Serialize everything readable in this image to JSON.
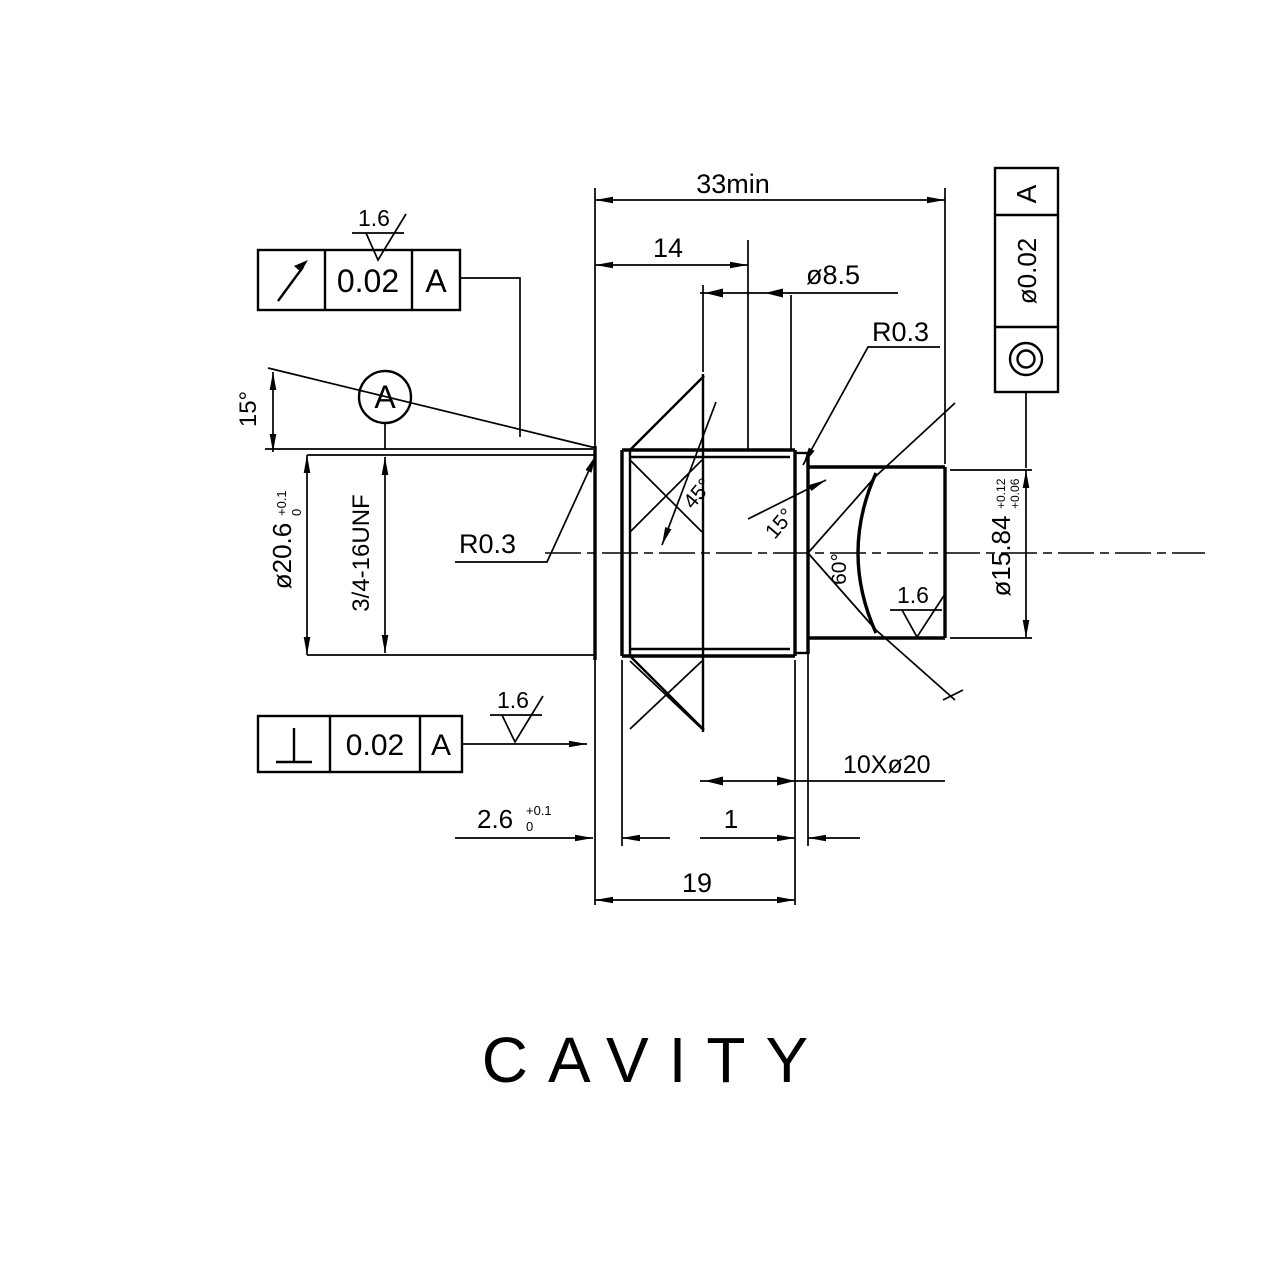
{
  "drawing": {
    "title": "CAVITY",
    "ink": "#000000",
    "background": "#ffffff"
  },
  "dims": {
    "overall_length": "33min",
    "thread_depth": "14",
    "pilot_hole": "ø8.5",
    "radius_right": "R0.3",
    "radius_left": "R0.3",
    "angle_left": "15°",
    "chamfer_angle": "45°",
    "seat_angle_small": "15°",
    "seat_angle_cone": "60°",
    "thread_minor": "ø20.6",
    "thread_minor_tol_up": "+0.1",
    "thread_minor_tol_lo": "0",
    "thread_spec": "3/4-16UNF",
    "relief_width": "2.6",
    "relief_tol_up": "+0.1",
    "relief_tol_lo": "0",
    "groove_width": "1",
    "groove_callout": "10Xø20",
    "bore_depth": "19",
    "bore_dia": "ø15.84",
    "bore_tol_up": "+0.12",
    "bore_tol_lo": "+0.06"
  },
  "gdt": {
    "runout": {
      "symbol": "circular-runout",
      "value": "0.02",
      "datum": "A"
    },
    "perpendicularity": {
      "symbol": "perpendicularity",
      "value": "0.02",
      "datum": "A"
    },
    "concentricity": {
      "symbol": "concentricity",
      "value": "ø0.02",
      "datum": "A"
    },
    "datum_label": "A"
  },
  "finish": {
    "top": "1.6",
    "bottom": "1.6",
    "inner": "1.6"
  }
}
